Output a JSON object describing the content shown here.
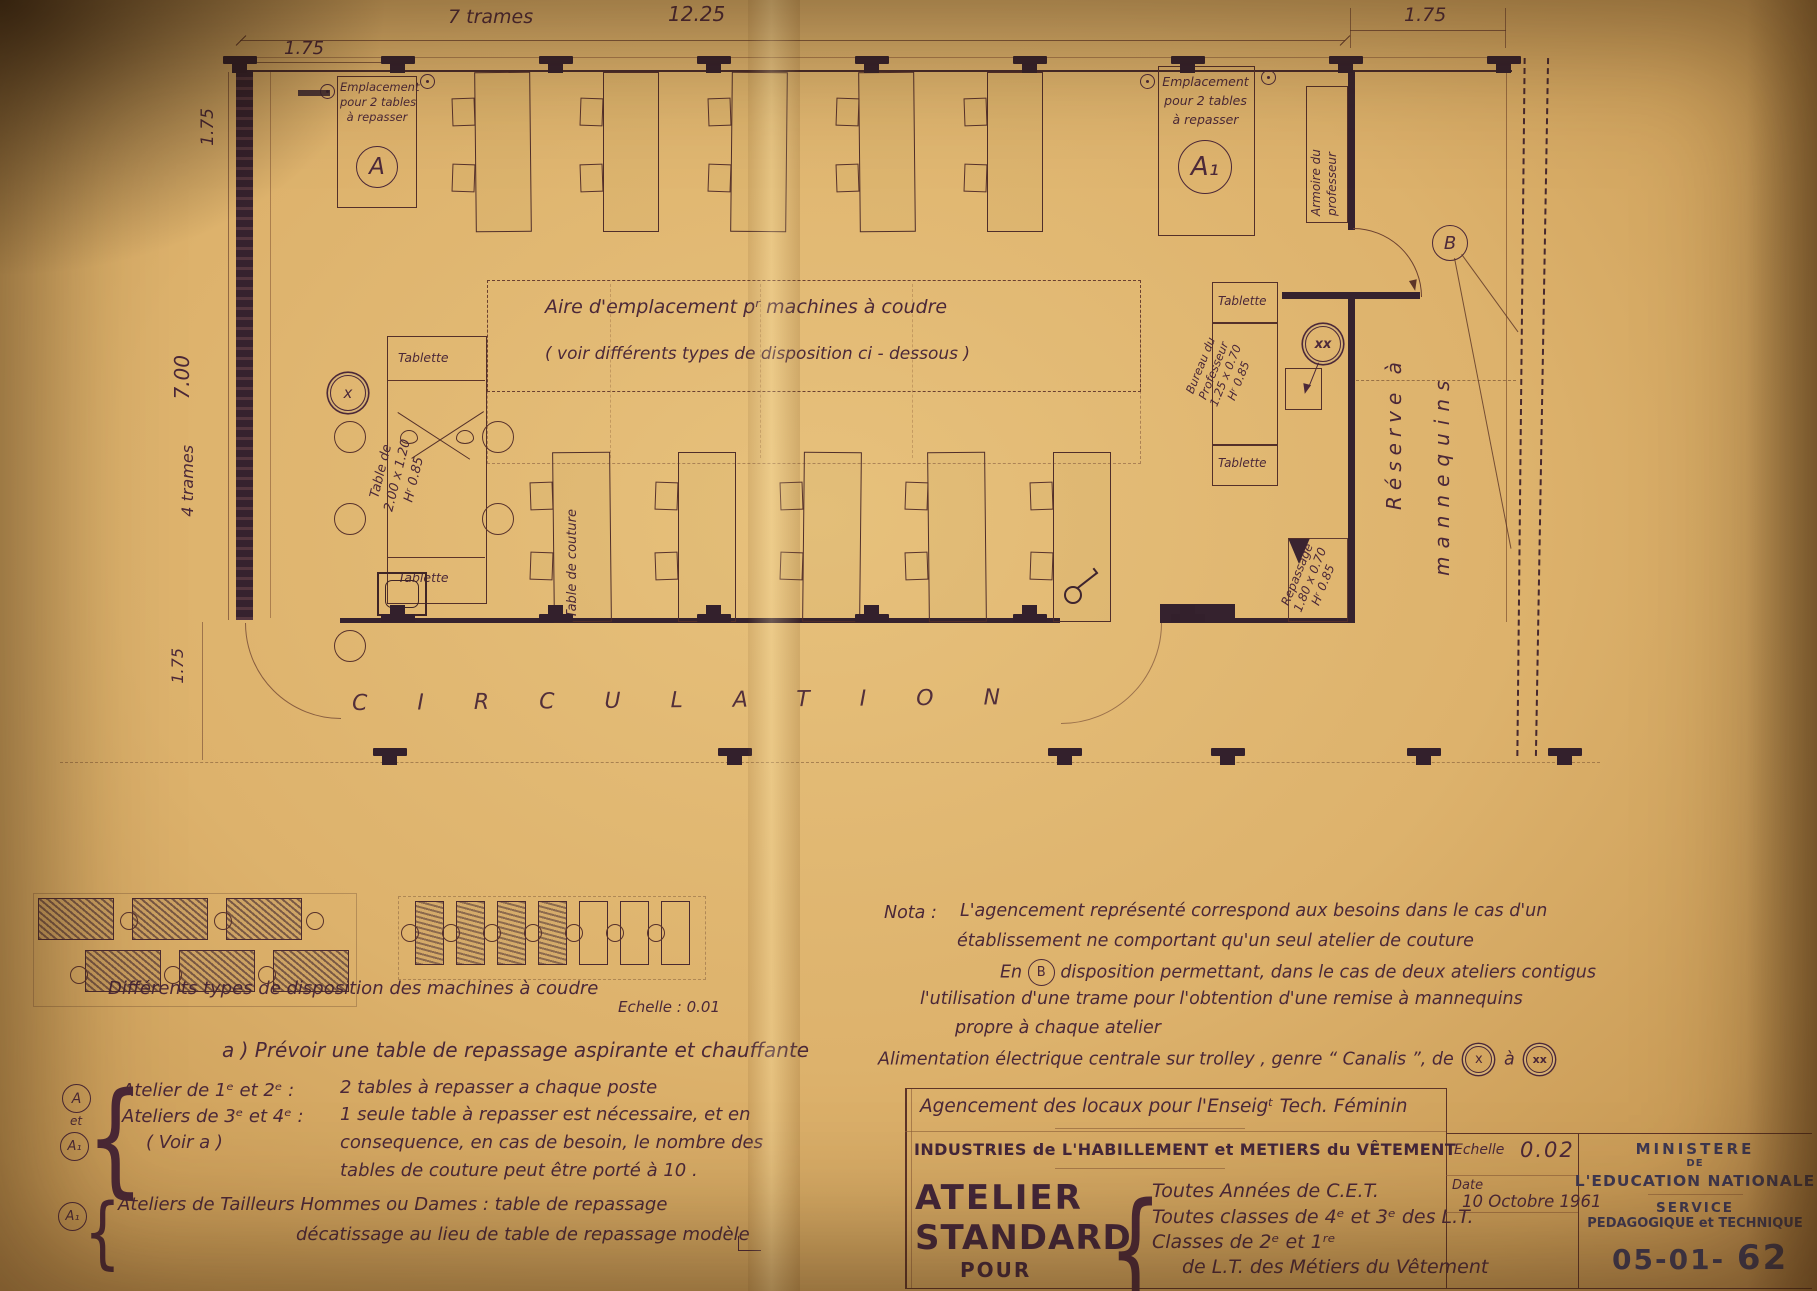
{
  "dims": {
    "trames7": "7 trames",
    "d1225": "12.25",
    "d175a": "1.75",
    "d175b": "1.75",
    "v175top": "1.75",
    "v700": "7.00",
    "trames4": "4 trames",
    "v175bot": "1.75"
  },
  "plan": {
    "emplacement": {
      "l1": "Emplacement",
      "l2": "pour 2 tables",
      "l3": "à repasser"
    },
    "labelA": "A",
    "labelA1": "A₁",
    "armoire": {
      "l1": "Armoire du",
      "l2": "professeur"
    },
    "aire": {
      "l1": "Aire d'emplacement pʳ machines à coudre",
      "l2": "( voir différents types de disposition ci - dessous )"
    },
    "tablette": "Tablette",
    "tableDe": {
      "l1": "Table de",
      "l2": "2.00 x 1.20",
      "l3": "Hʳ 0.85"
    },
    "tableCouture": "Table de couture",
    "bureau": {
      "l1": "Bureau du",
      "l2": "Professeur",
      "l3": "1.25 x 0.70",
      "l4": "Hʳ 0.85"
    },
    "repassage": {
      "l1": "Repassage",
      "l2": "1.80 x 0.70",
      "l3": "Hʳ 0.85"
    },
    "reserve": {
      "l1": "Réserve à",
      "l2": "mannequins"
    },
    "circulation": "CIRCULATION",
    "markX": "x",
    "markXX": "xx",
    "markB": "B"
  },
  "lower": {
    "caption": "Différents types de disposition des machines à coudre",
    "echelle": "Echelle : 0.01",
    "nota": {
      "l1a": "Nota :",
      "l1b": "L'agencement représenté correspond aux besoins dans le cas d'un",
      "l2": "établissement ne comportant qu'un seul atelier de couture",
      "l3a": "En",
      "l3b": "disposition permettant, dans le cas de deux ateliers contigus",
      "l4": "l'utilisation d'une trame pour l'obtention d'une remise à mannequins",
      "l5": "propre à chaque atelier"
    },
    "alim": {
      "a": "Alimentation électrique centrale sur trolley , genre “ Canalis ”, de",
      "b": "à"
    },
    "noteA": "a )  Prévoir une table de repassage aspirante et chauffante",
    "blockA": {
      "et": "et",
      "c1r1": "Atelier de 1ᵉ et 2ᵉ :",
      "c1r2": "Ateliers de 3ᵉ et 4ᵉ :",
      "c1r3": "( Voir a )",
      "c2r1": "2 tables à repasser a chaque poste",
      "c2r2": "1 seule table à repasser est nécessaire, et en",
      "c2r3": "consequence, en cas de besoin, le nombre des",
      "c2r4": "tables de couture peut être porté à 10 ."
    },
    "blockA1": {
      "r1": "Ateliers de Tailleurs Hommes ou Dames : table de repassage",
      "r2": "décatissage au lieu de table de repassage modèle"
    }
  },
  "titleblock": {
    "r1": "Agencement des locaux pour l'Enseigᵗ Tech. Féminin",
    "r2": "INDUSTRIES de L'HABILLEMENT et METIERS du VÊTEMENT",
    "big1": "ATELIER",
    "big2": "STANDARD",
    "big3": "POUR",
    "list": [
      "Toutes Années de C.E.T.",
      "Toutes classes de 4ᵉ et 3ᵉ des L.T.",
      "Classes de 2ᵉ et 1ʳᵉ",
      "de L.T. des Métiers du Vêtement"
    ],
    "echelleLabel": "Echelle",
    "echelleVal": "0.02",
    "dateLabel": "Date",
    "dateVal": "10 Octobre 1961",
    "min1": "MINISTERE",
    "min2": "DE",
    "min3": "L'EDUCATION NATIONALE",
    "svc1": "SERVICE",
    "svc2": "PEDAGOGIQUE et TECHNIQUE",
    "ref1": "05-01-",
    "ref2": "62"
  },
  "colors": {
    "ink": "#4b2838",
    "wall": "#35222e",
    "paper": "#ddb26c",
    "blue_ink": "#3e3852"
  }
}
